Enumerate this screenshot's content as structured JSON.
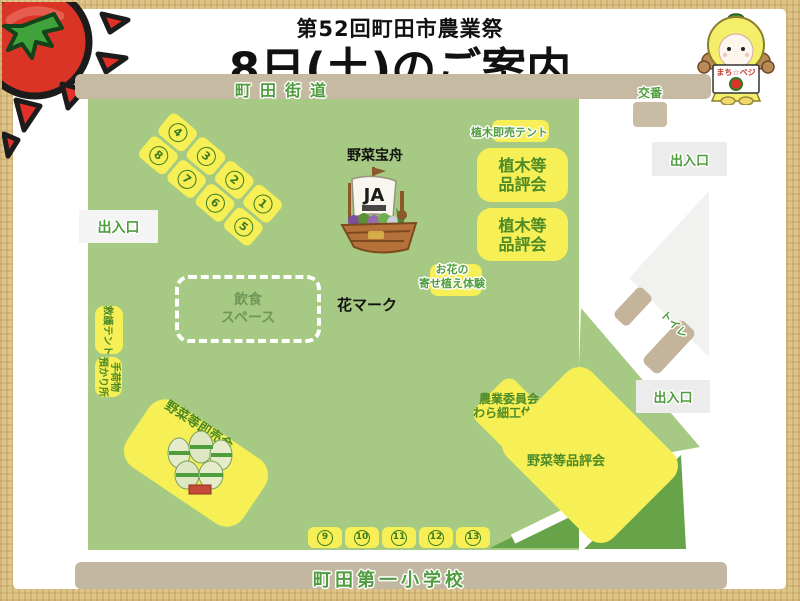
{
  "title": {
    "line1": "第52回町田市農業祭",
    "line2": "8日(土)のご案内"
  },
  "mascot": {
    "sign": "まち☆ベジ"
  },
  "roads": {
    "top": "町田街道",
    "bottom": "町田第一小学校"
  },
  "common": {
    "exit": "出入口",
    "police": "交番",
    "toilet": "トイレ"
  },
  "booths": {
    "grid_row1": [
      "4",
      "3",
      "2",
      "1"
    ],
    "grid_row2": [
      "8",
      "7",
      "6",
      "5"
    ],
    "bottom_row": [
      "9",
      "10",
      "11",
      "12",
      "13"
    ]
  },
  "areas": {
    "treasure_ship": "野菜宝舟",
    "ship_sail": "JA",
    "flower_mark": "花マーク",
    "food_space_l1": "飲食",
    "food_space_l2": "スペース",
    "planting_tent": "植木即売テント",
    "plant_show_l1": "植木等",
    "plant_show_l2": "品評会",
    "flower_exp_l1": "お花の",
    "flower_exp_l2": "寄せ植え体験",
    "firstaid_tent": "救護テント",
    "baggage_l1": "手荷物",
    "baggage_l2": "預かり所",
    "veg_market": "野菜等即売会",
    "agri_committee_l1": "農業委員会",
    "agri_committee_l2": "わら細工体験",
    "veg_show": "野菜等品評会"
  },
  "colors": {
    "field_green": "#a6ca83",
    "dark_green": "#67a348",
    "booth_yellow": "#f6ef55",
    "road_tan": "#c6baa2",
    "label_green": "#4f9d3e",
    "tomato_red": "#d93425"
  }
}
